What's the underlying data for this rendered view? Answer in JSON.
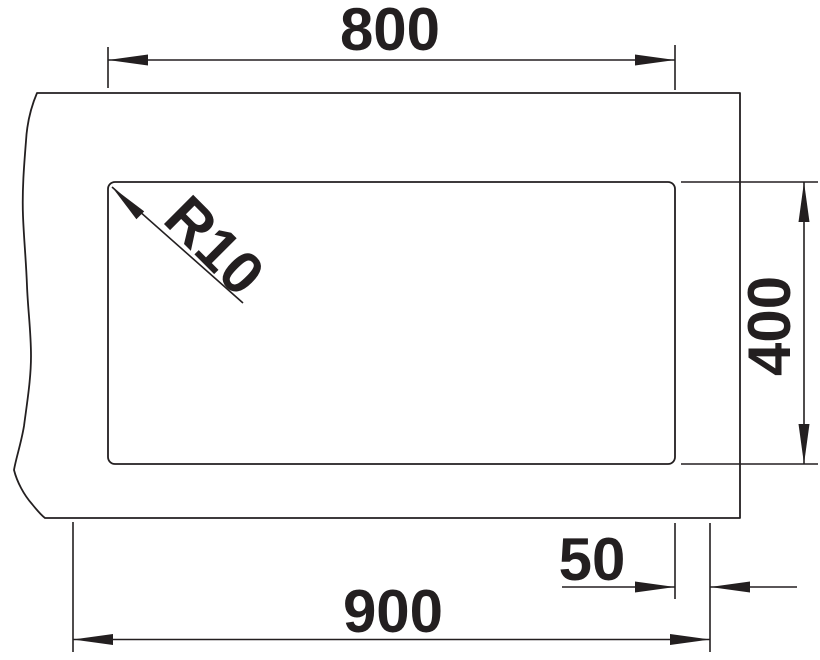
{
  "colors": {
    "ink": "#231f20",
    "bg": "#ffffff"
  },
  "drawing": {
    "dimensions": {
      "cutout_width": {
        "label": "800"
      },
      "cutout_height": {
        "label": "400"
      },
      "overall_width": {
        "label": "900"
      },
      "side_offset": {
        "label": "50"
      },
      "corner_radius": {
        "label": "R10"
      }
    }
  }
}
